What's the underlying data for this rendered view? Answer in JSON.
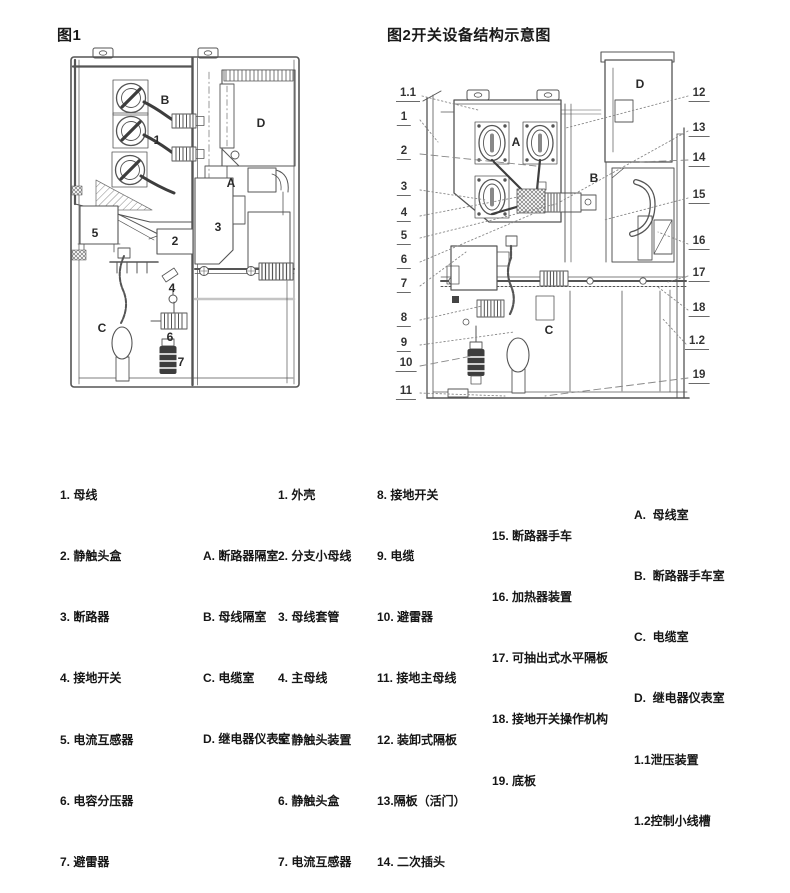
{
  "titles": {
    "fig1": "图1",
    "fig2": "图2开关设备结构示意图"
  },
  "fig1": {
    "labels": [
      "B",
      "1",
      "D",
      "A",
      "5",
      "2",
      "3",
      "4",
      "C",
      "6",
      "7"
    ]
  },
  "fig2": {
    "labels": [
      "A",
      "B",
      "C",
      "D"
    ],
    "callouts_left": [
      "1.1",
      "1",
      "2",
      "3",
      "4",
      "5",
      "6",
      "7",
      "8",
      "9",
      "10",
      "11"
    ],
    "callouts_right": [
      "12",
      "13",
      "14",
      "15",
      "16",
      "17",
      "18",
      "1.2",
      "19"
    ]
  },
  "legend": {
    "fig1_items": [
      "1. 母线",
      "2. 静触头盒",
      "3. 断路器",
      "4. 接地开关",
      "5. 电流互感器",
      "6. 电容分压器",
      "7. 避雷器"
    ],
    "fig1_rooms": [
      "A. 断路器隔室",
      "B. 母线隔室",
      "C. 电缆室",
      "D. 继电器仪表室"
    ],
    "fig2_items_a": [
      "1. 外壳",
      "2. 分支小母线",
      "3. 母线套管",
      "4. 主母线",
      "5. 静触头装置",
      "6. 静触头盒",
      "7. 电流互感器"
    ],
    "fig2_items_b": [
      "8. 接地开关",
      "9. 电缆",
      "10. 避雷器",
      "11. 接地主母线",
      "12. 装卸式隔板",
      "13.隔板（活门）",
      "14. 二次插头"
    ],
    "fig2_items_c": [
      "15. 断路器手车",
      "16. 加热器装置",
      "17. 可抽出式水平隔板",
      "18. 接地开关操作机构",
      "19. 底板"
    ],
    "fig2_rooms": [
      "A.  母线室",
      "B.  断路器手车室",
      "C.  电缆室",
      "D.  继电器仪表室",
      "1.1泄压装置",
      "1.2控制小线槽"
    ]
  },
  "colors": {
    "line": "#555555",
    "thick_conductor": "#3d3d3d",
    "leader": "#888888",
    "text": "#161616"
  }
}
